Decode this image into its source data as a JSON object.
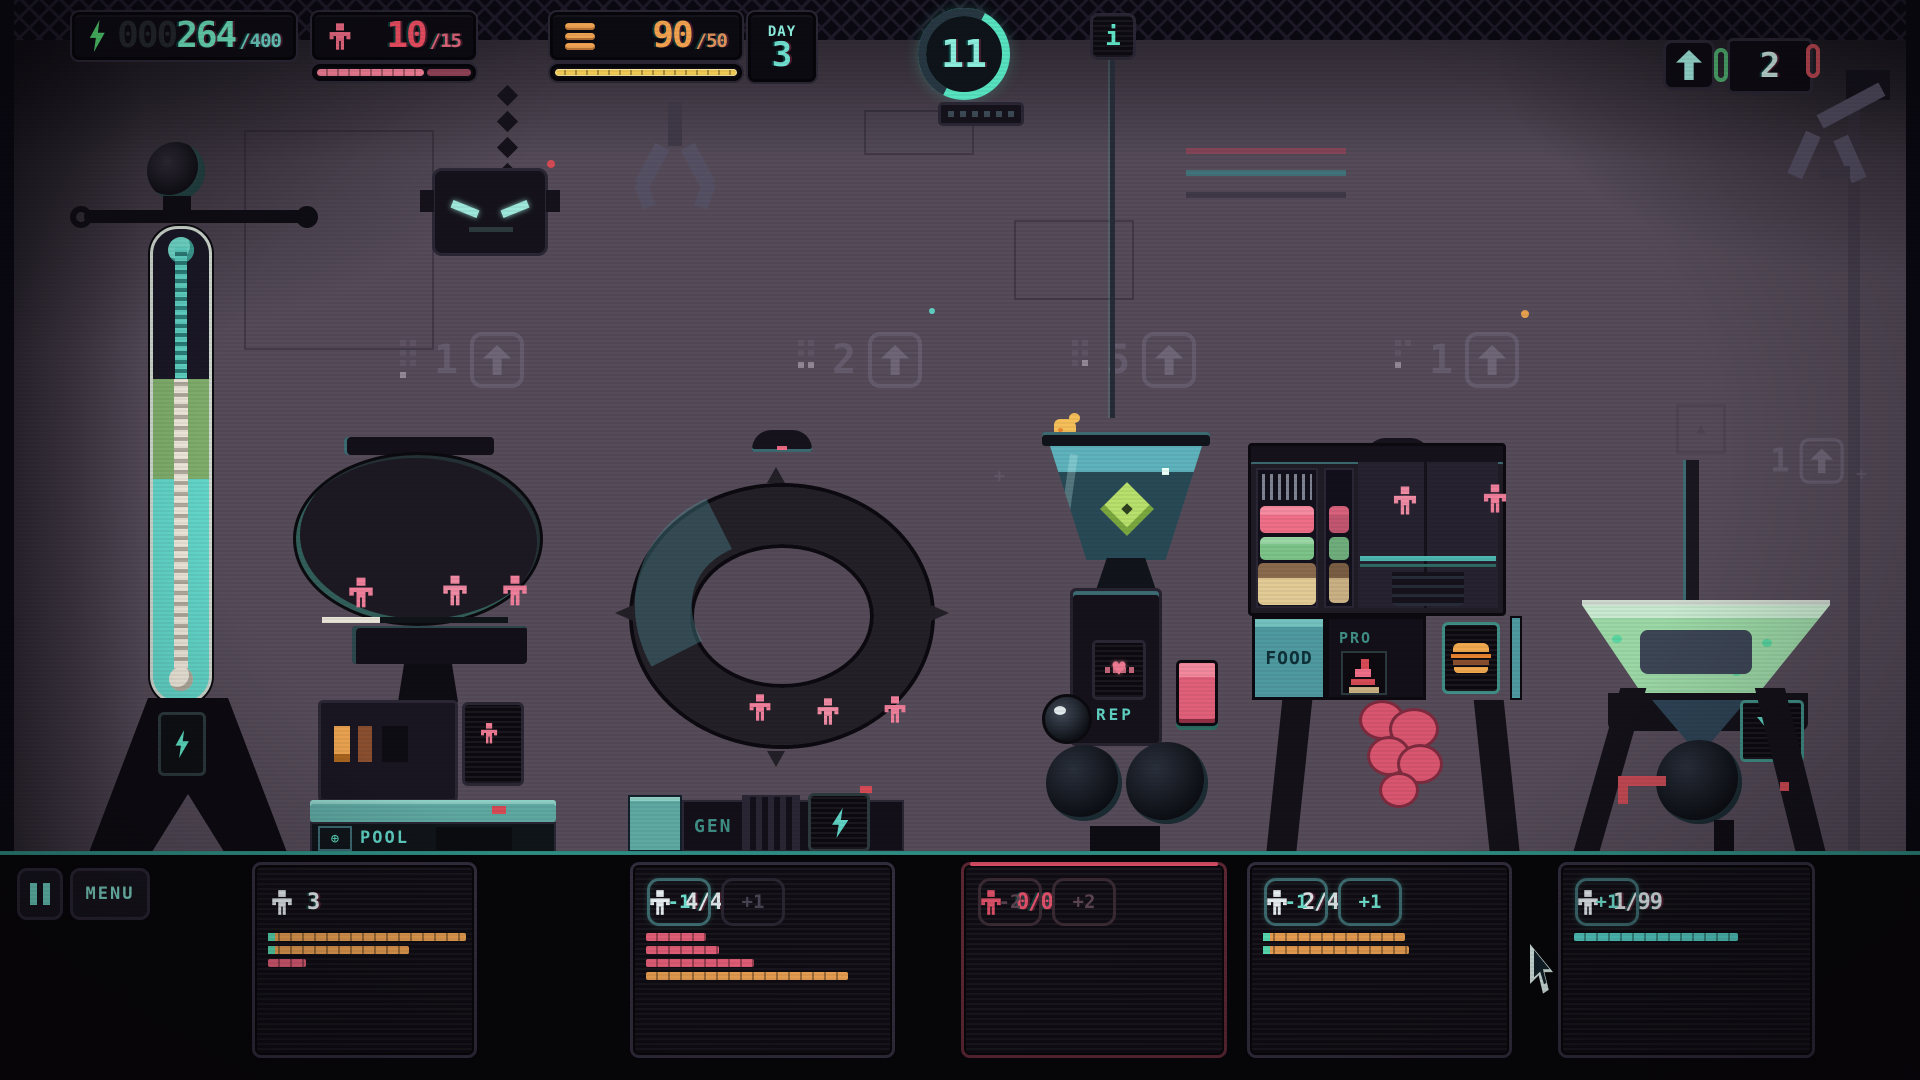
{
  "colors": {
    "teal": "#5fe3c6",
    "teal_soft": "#7fd8c8",
    "green": "#54d973",
    "orange": "#efa353",
    "yellow": "#f0ca57",
    "pink": "#ef7b93",
    "red": "#e0506a",
    "white": "#e6edf0",
    "bar_orange": "#efa353",
    "bar_pink": "#e8607a",
    "bar_teal": "#56d4cb",
    "bar_cap": "#5ae0b4"
  },
  "hud": {
    "energy": {
      "pad": "000",
      "value": "264",
      "max": "/400"
    },
    "people": {
      "value": "10",
      "max": "/15",
      "fill_pct": 68
    },
    "food": {
      "value": "90",
      "max": "/50",
      "fill_pct": 100
    },
    "day": {
      "label": "DAY",
      "value": "3"
    },
    "wave": {
      "value": "11"
    },
    "info": {
      "glyph": "i"
    },
    "storage": {
      "value": "2"
    }
  },
  "world": {
    "badges": [
      {
        "value": "1"
      },
      {
        "value": "2"
      },
      {
        "value": "5"
      },
      {
        "value": "1"
      },
      {
        "value": "1"
      }
    ],
    "labels": {
      "pool": "POOL",
      "gen": "GEN",
      "rep": "REP",
      "food": "FOOD",
      "pro": "PRO"
    }
  },
  "bottom": {
    "menu": "MENU",
    "panels": [
      {
        "count": "3"
      },
      {
        "count": "4/4",
        "minus": "-1",
        "plus": "+1"
      },
      {
        "count": "0/0",
        "minus": "-2",
        "plus": "+2"
      },
      {
        "count": "2/4",
        "minus": "-1",
        "plus": "+1"
      },
      {
        "count": "1/99",
        "plus": "+1"
      }
    ],
    "bars": [
      [
        {
          "color": "bar_orange",
          "w": 198,
          "cap": true
        },
        {
          "color": "bar_orange",
          "w": 141,
          "cap": true
        },
        {
          "color": "bar_pink",
          "w": 38
        }
      ],
      [
        {
          "color": "bar_pink",
          "w": 60
        },
        {
          "color": "bar_pink",
          "w": 73
        },
        {
          "color": "bar_pink",
          "w": 108
        },
        {
          "color": "bar_orange",
          "w": 202
        }
      ],
      [],
      [
        {
          "color": "bar_orange",
          "w": 142,
          "cap": true
        },
        {
          "color": "bar_orange",
          "w": 146,
          "cap": true
        }
      ],
      [
        {
          "color": "bar_teal",
          "w": 164
        }
      ]
    ]
  }
}
